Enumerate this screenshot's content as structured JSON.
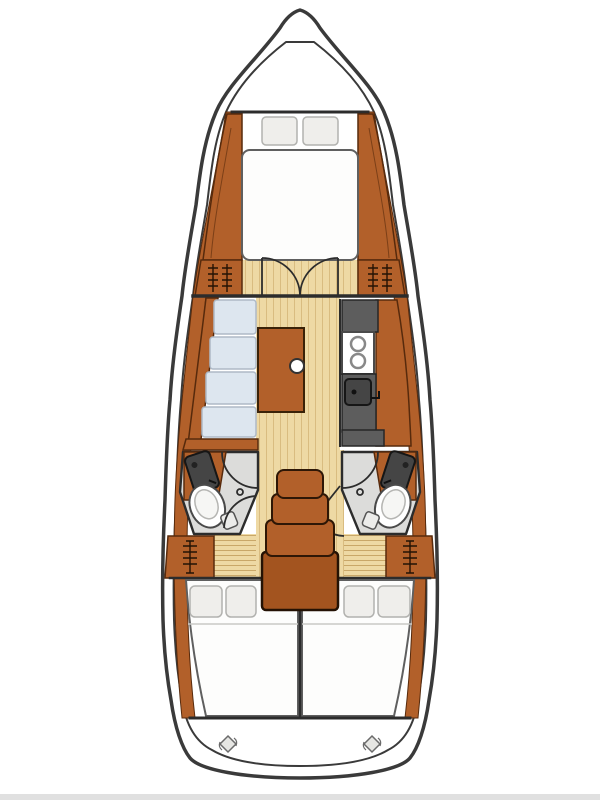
{
  "title": "Sailboat interior layout floor plan (top view)",
  "palette": {
    "outline": "#3a3a3a",
    "line": "#2c2c2c",
    "wood": "#b2602a",
    "wood_deep": "#a3541f",
    "wood_stroke": "#572a0c",
    "floor": "#eed9a4",
    "plank": "#d9bc80",
    "slat": "#c9a768",
    "counter": "#5d5d5d",
    "counter_dark": "#454545",
    "cushion": "#dde6ef",
    "cushion_edge": "#aeb9c6",
    "tile": "#dcdcda",
    "bed": "#fdfdfc",
    "pillow": "#efeeeb",
    "edge_strip": "#e0e0e0"
  },
  "fixtures": {
    "forward_cabin": [
      "v-berth-bed",
      "pillow",
      "pillow",
      "side-shelf",
      "side-shelf"
    ],
    "forward_bulkhead": [
      "hanging-locker",
      "double-door",
      "hanging-locker"
    ],
    "saloon": [
      "l-settee",
      "saloon-table",
      "table-knob"
    ],
    "galley": [
      "counter",
      "two-burner-stove",
      "sink",
      "faucet"
    ],
    "heads": [
      "toilet",
      "vanity-sink",
      "door",
      "toilet",
      "vanity-sink",
      "door"
    ],
    "companionway": [
      "steps"
    ],
    "aft_cabins": [
      "double-berth",
      "double-berth",
      "hanging-locker",
      "hanging-locker"
    ],
    "transom": [
      "deck-fitting",
      "deck-fitting"
    ]
  },
  "counts": {
    "cabins": 3,
    "heads": 2,
    "forward_pillows": 2,
    "aft_pillows": 4,
    "stove_burners": 2,
    "companionway_steps": 4,
    "deck_fittings": 2
  }
}
